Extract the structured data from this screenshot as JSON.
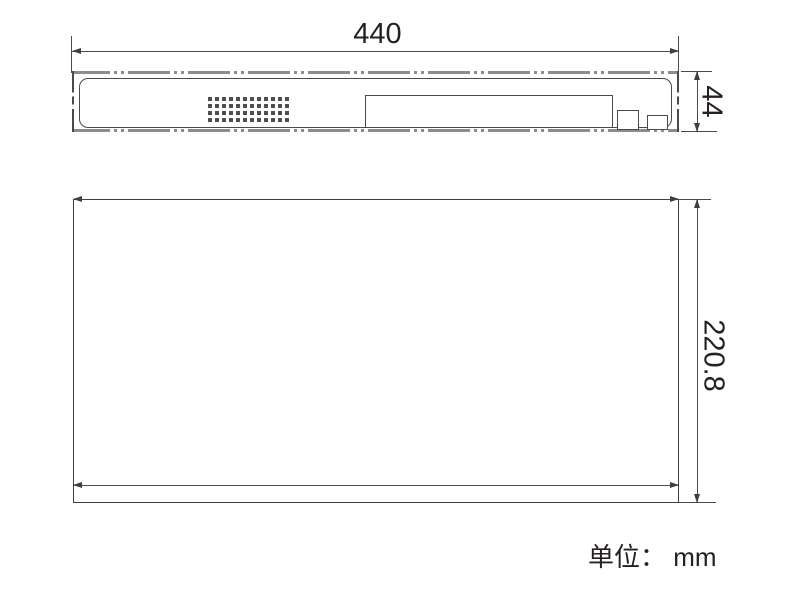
{
  "front_view": {
    "width_dim": {
      "label": "440"
    },
    "height_dim": {
      "label": "44"
    },
    "vent_grid": {
      "rows": 4,
      "cols": 12,
      "hole_size_px": 4,
      "gap_px": 3
    },
    "display_window": {
      "present": true
    },
    "small_squares": 2
  },
  "top_view": {
    "depth_dim": {
      "label": "220.8"
    }
  },
  "footer": {
    "unit_label": "单位： mm"
  },
  "colors": {
    "background": "#ffffff",
    "line": "#4a4a4a",
    "arrow": "#3f3f3f",
    "panel_edge_gray": "#8c8c8c",
    "vent_dot": "#4f4f4f",
    "text": "#262021"
  }
}
